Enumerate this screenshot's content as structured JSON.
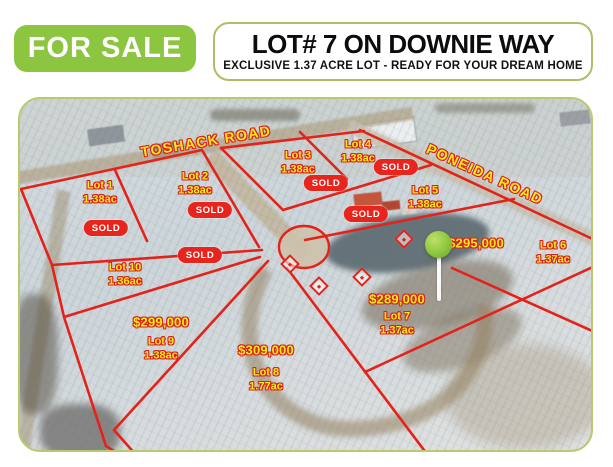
{
  "banner": {
    "for_sale_label": "FOR SALE",
    "title": "LOT# 7 ON DOWNIE WAY",
    "subtitle": "EXCLUSIVE 1.37 ACRE LOT - READY FOR YOUR DREAM HOME"
  },
  "map": {
    "roads": [
      {
        "name": "TOSHACK ROAD"
      },
      {
        "name": "PONEIDA ROAD"
      }
    ],
    "lots": [
      {
        "name": "Lot 1",
        "acreage": "1.38ac",
        "status": "sold",
        "sold_label": "SOLD"
      },
      {
        "name": "Lot 2",
        "acreage": "1.38ac",
        "status": "sold",
        "sold_label": "SOLD"
      },
      {
        "name": "Lot 3",
        "acreage": "1.38ac",
        "status": "sold",
        "sold_label": "SOLD"
      },
      {
        "name": "Lot 4",
        "acreage": "1.38ac",
        "status": "sold",
        "sold_label": "SOLD"
      },
      {
        "name": "Lot 5",
        "acreage": "1.38ac",
        "status": "sold",
        "sold_label": "SOLD"
      },
      {
        "name": "Lot 6",
        "acreage": "1.37ac",
        "status": "for_sale",
        "price": "$295,000"
      },
      {
        "name": "Lot 7",
        "acreage": "1.37ac",
        "status": "for_sale",
        "price": "$289,000"
      },
      {
        "name": "Lot 8",
        "acreage": "1.77ac",
        "status": "for_sale",
        "price": "$309,000"
      },
      {
        "name": "Lot 9",
        "acreage": "1.38ac",
        "status": "for_sale",
        "price": "$299,000"
      },
      {
        "name": "Lot 10",
        "acreage": "1.36ac",
        "status": "sold",
        "sold_label": "SOLD"
      }
    ],
    "pin": {
      "marks": "Lot 7"
    }
  },
  "colors": {
    "accent_green": "#8cc641",
    "boundary_red": "#e3231a",
    "label_yellow": "#f6e71f",
    "sold_red": "#e8251d",
    "frame_olive": "#b9ca6e"
  }
}
